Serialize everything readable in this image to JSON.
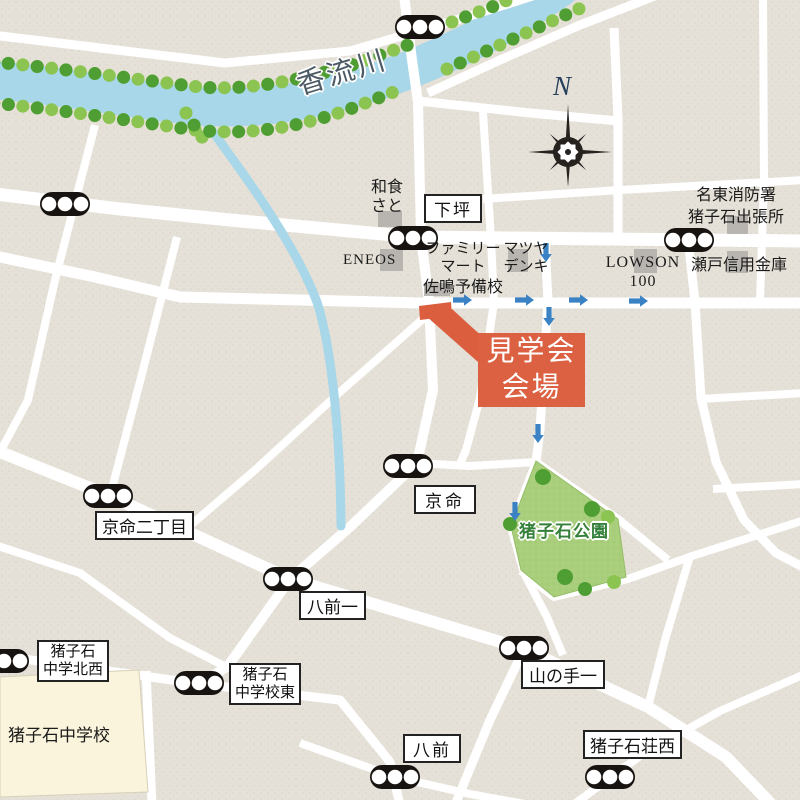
{
  "colors": {
    "background": "#e6e1d8",
    "road": "#ffffff",
    "river": "#a7d7e8",
    "tree_dark": "#4f9e33",
    "tree_light": "#8cc452",
    "park_fill": "#a9cf7d",
    "park_label": "#35803a",
    "venue_orange": "#dc6142",
    "route_arrow_blue": "#3b82c4",
    "building_gray": "#b4b1ad",
    "school_cream": "#faf4dc",
    "signal_black": "#171310",
    "compass_ink": "#26221e"
  },
  "river": {
    "name": "香流川"
  },
  "compass": {
    "north_label": "N"
  },
  "venue": {
    "line1": "見学会",
    "line2": "会場"
  },
  "labels": {
    "washoku_line1": "和食",
    "washoku_line2": "さと",
    "shimotsubo": "下坪",
    "eneos": "ENEOS",
    "familymart_line1": "ファミリー",
    "familymart_line2": "マート",
    "matsuyadenki_line1": "マツヤ",
    "matsuyadenki_line2": "デンキ",
    "sanaru": "佐鳴予備校",
    "lawson_line1": "LOWSON",
    "lawson_line2": "100",
    "seto_shinkin": "瀬戸信用金庫",
    "meito_fire_line1": "名東消防署",
    "meito_fire_line2": "猪子石出張所",
    "kyomei_2chome": "京命二丁目",
    "kyomei": "京命",
    "hachimae_1": "八前一",
    "park": "猪子石公園",
    "inokoshi_nw_line1": "猪子石",
    "inokoshi_nw_line2": "中学北西",
    "inokoshi_school": "猪子石中学校",
    "inokoshi_east_line1": "猪子石",
    "inokoshi_east_line2": "中学校東",
    "yamanote_1": "山の手一",
    "hachimae": "八前",
    "inokoshi_so_nishi": "猪子石荘西"
  }
}
